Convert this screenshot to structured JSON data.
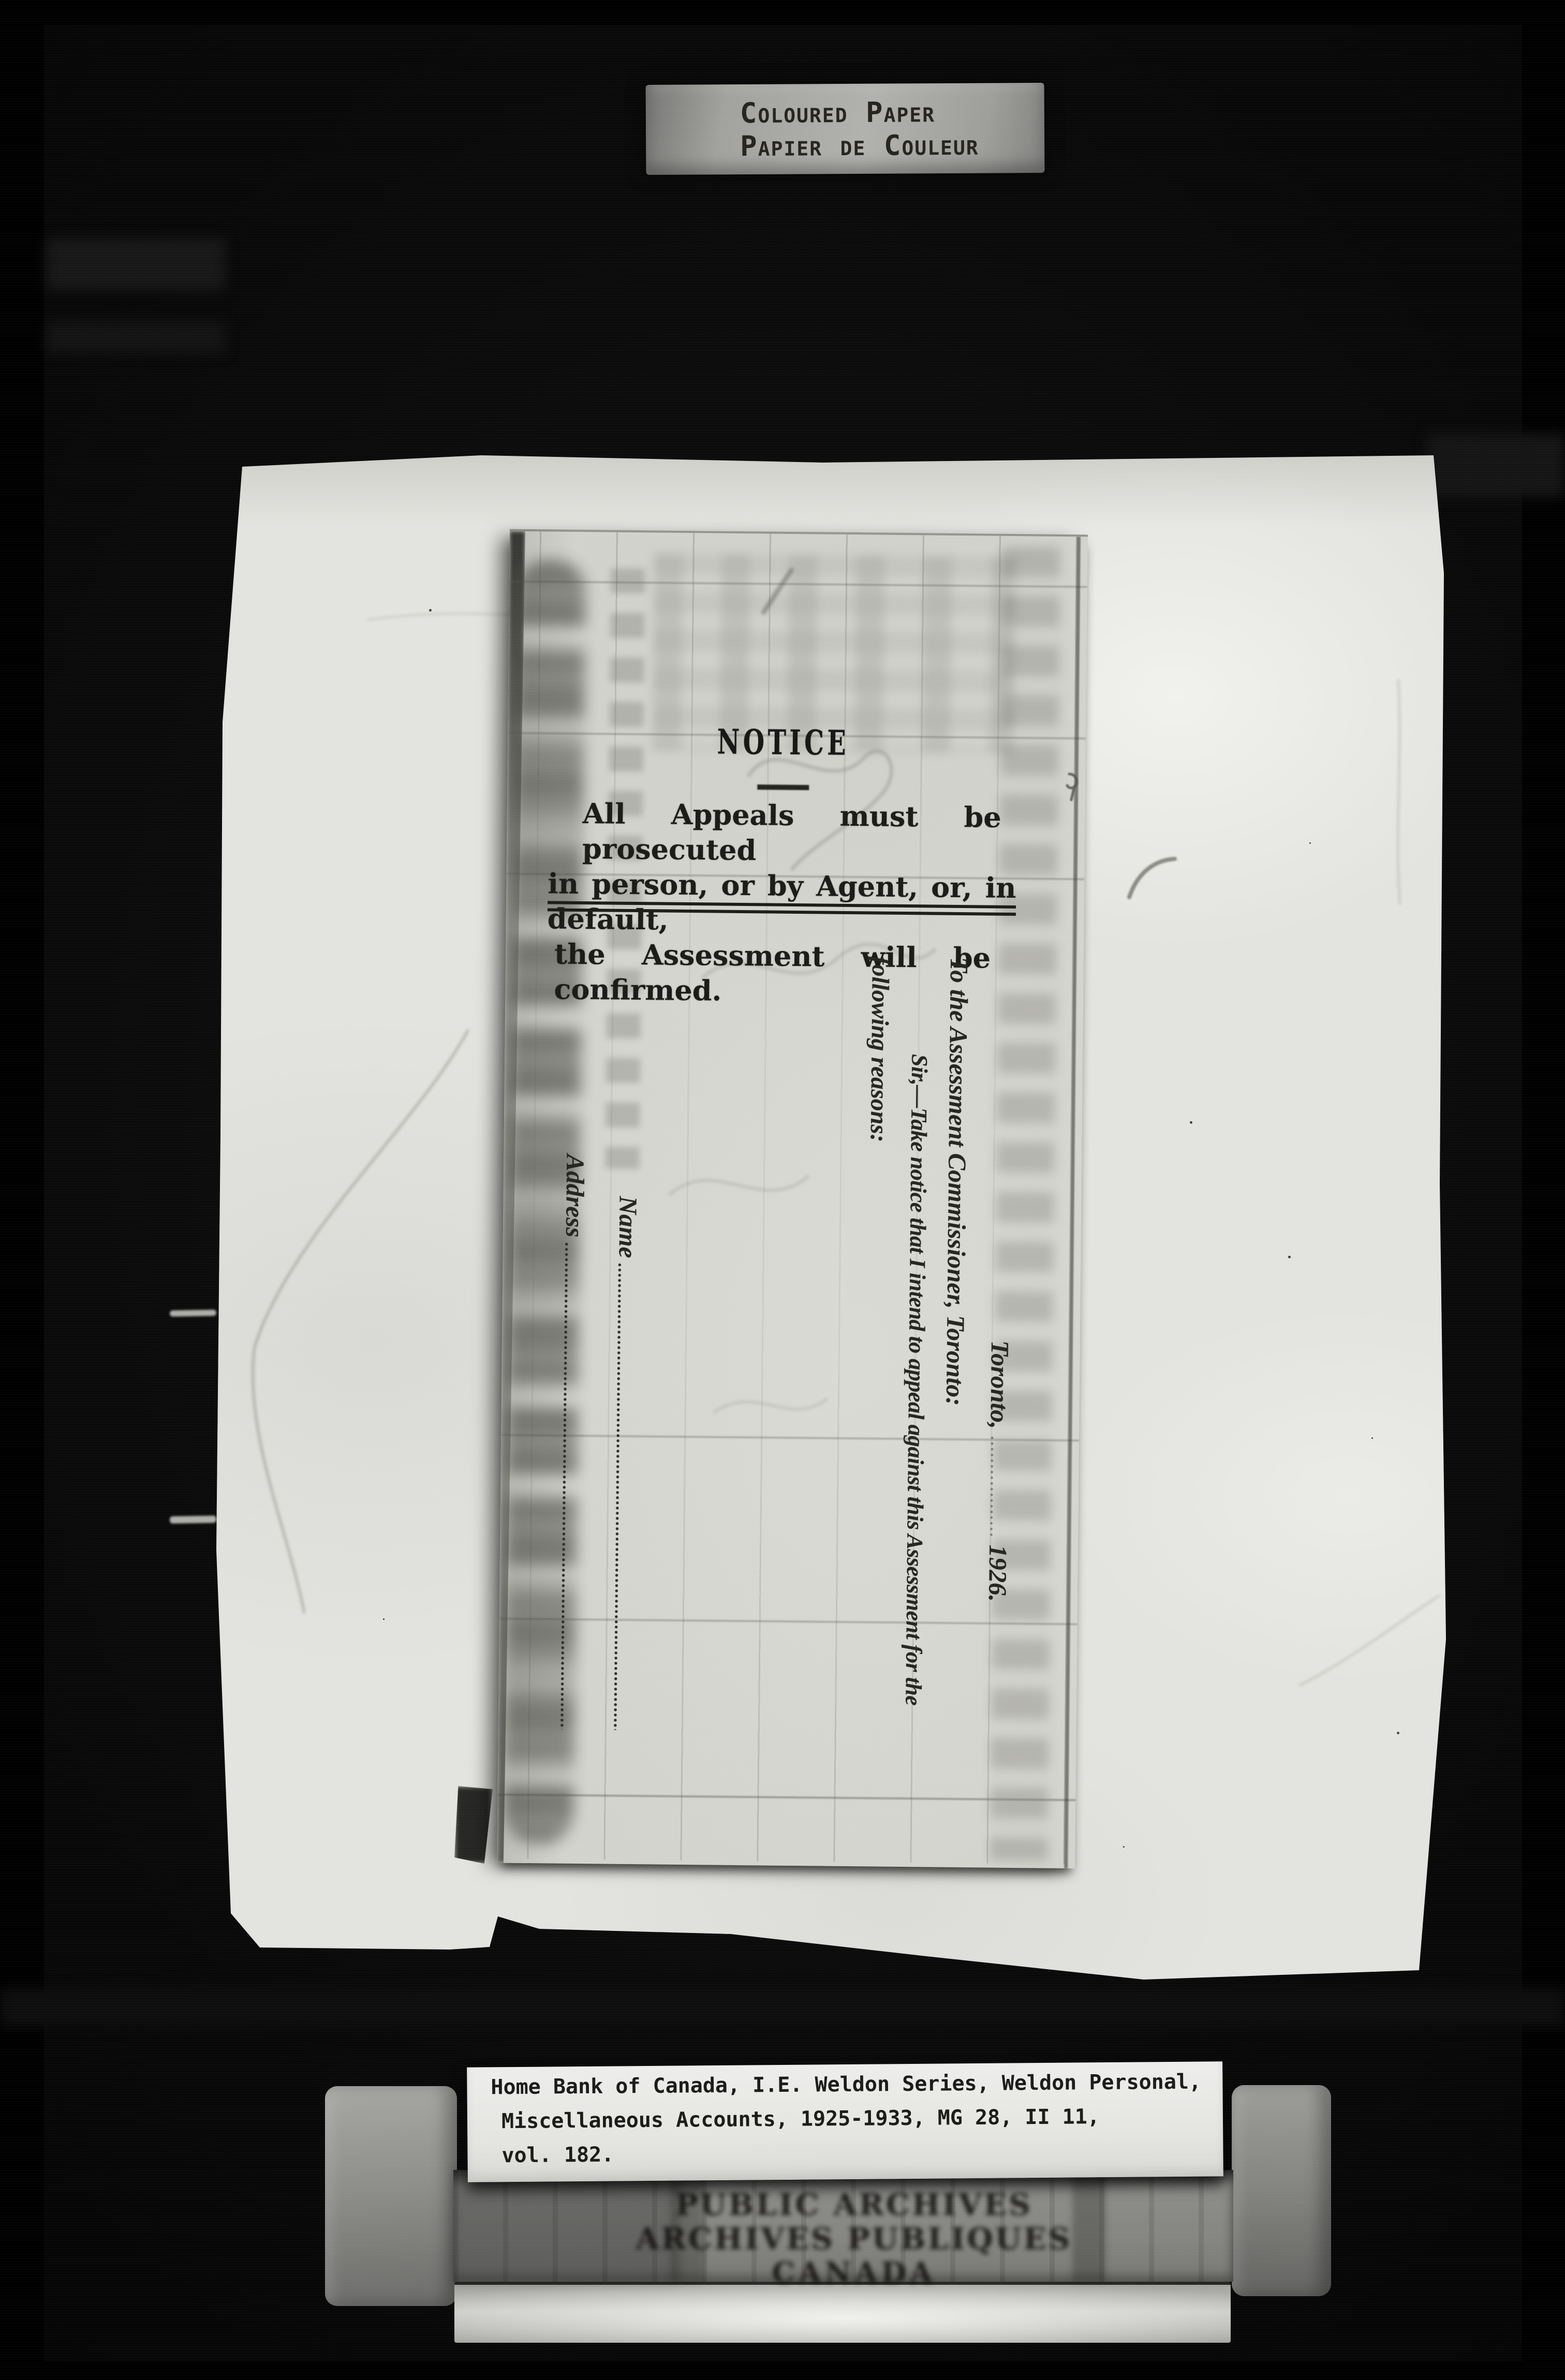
{
  "archive_header_label": {
    "line1": "Coloured Paper",
    "line2": "Papier de Couleur"
  },
  "notice_card": {
    "title": "NOTICE",
    "paragraph_lines": [
      "All Appeals must be prosecuted",
      "in person, or by Agent, or, in default,",
      "the Assessment will be confirmed."
    ],
    "form": {
      "city": "Toronto,",
      "year": "1926.",
      "salutation": "To the Assessment Commissioner, Toronto:",
      "body_line1": "Sir,—Take notice that I intend to appeal against this Assessment for the",
      "body_line2": "following reasons:",
      "name_label": "Name",
      "address_label": "Address"
    }
  },
  "reference_label": {
    "line1": "Home Bank of Canada, I.E. Weldon Series, Weldon Personal,",
    "line2": "Miscellaneous Accounts, 1925-1933, MG 28, II 11,",
    "line3": "vol. 182."
  },
  "archive_stamp": {
    "line1": "PUBLIC ARCHIVES",
    "line2": "ARCHIVES PUBLIQUES",
    "line3": "CANADA"
  },
  "colors": {
    "film_black": "#0b0b0b",
    "paper_white": "#e3e3df",
    "card_grey": "#d3d3ce",
    "ink_black": "#1b1b19",
    "label_grey": "#a6a6a3",
    "label_white": "#e9e9e6"
  }
}
